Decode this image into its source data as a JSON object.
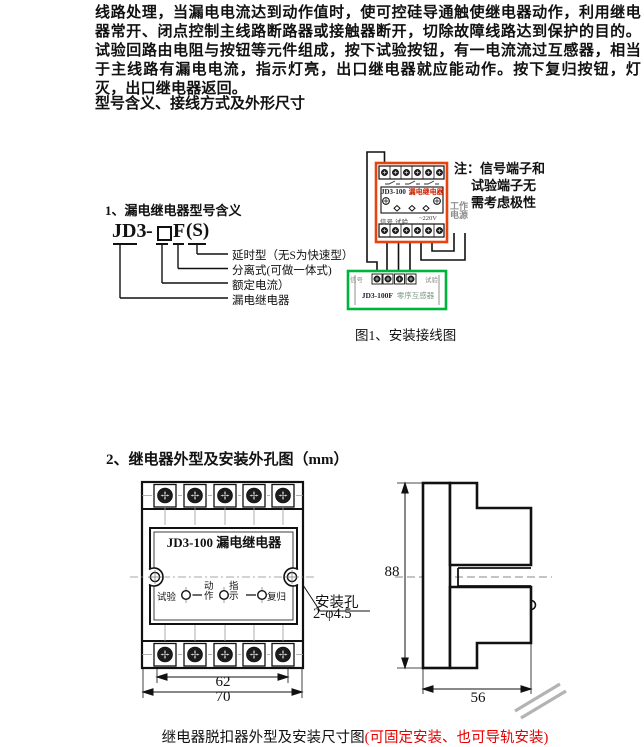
{
  "page": {
    "intro_paragraph": "线路处理，当漏电电流达到动作值时，使可控硅导通触使继电器动作，利用继电器常开、闭点控制主线路断路器或接触器断开，切除故障线路达到保护的目的。试验回路由电阻与按钮等元件组成，按下试验按钮，有一电流流过互感器，相当于主线路有漏电电流，指示灯亮，出口继电器就应能动作。按下复归按钮，灯灭，出口继电器返回。",
    "section1_heading": "型号含义、接线方式及外形尺寸",
    "section2_heading": "2、继电器外型及安装外孔图（mm）"
  },
  "model_diagram": {
    "title": "1、漏电继电器型号含义",
    "model_prefix": "JD3",
    "model_sep": "-",
    "model_suffix": "F",
    "model_option": "(S)",
    "labels": [
      "延时型（无S为快速型）",
      "分离式(可做一体式)",
      "额定电流）",
      "漏电继电器"
    ]
  },
  "wiring_diagram": {
    "relay_model": "JD3-100",
    "relay_name": "漏电继电器",
    "signal_label": "信号",
    "test_label": "试验",
    "power_value": "~220V",
    "note_line1": "注：信号端子和",
    "note_line2": "试验端子无",
    "note_line3": "需考虑极性",
    "power_line1": "工作",
    "power_line2": "电源",
    "transformer_model": "JD3-100F",
    "transformer_name": "零序互感器",
    "transformer_left": "信号",
    "transformer_right": "试验",
    "caption": "图1、安装接线图"
  },
  "outline_drawing": {
    "front_title": "JD3-100 漏电继电器",
    "btn_test": "试验",
    "lamp_action": "动作",
    "lamp_indicate": "指示",
    "btn_reset": "复归",
    "mount_hole_label": "安装孔",
    "mount_hole_spec": "2-φ4.5",
    "dim_inner_width": "62",
    "dim_outer_width": "70",
    "dim_height": "88",
    "dim_depth": "56"
  },
  "footer": {
    "caption_black": "继电器脱扣器外型及安装尺寸图",
    "caption_red": "(可固定安装、也可导轨安装)"
  },
  "colors": {
    "relay_border": "#e8430f",
    "transformer_border": "#00b33c",
    "relay_name_red": "#cc2200"
  }
}
